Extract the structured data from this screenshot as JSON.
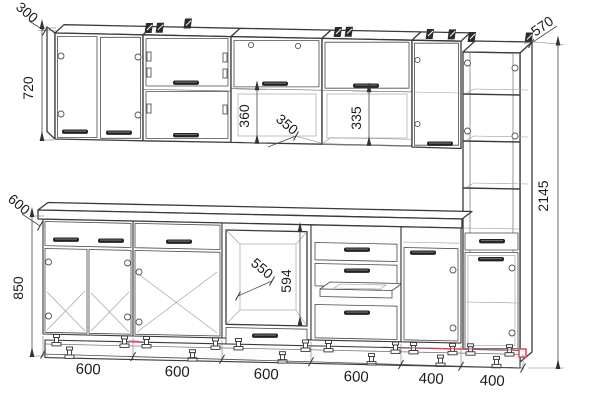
{
  "drawing": {
    "type": "kitchen-elevation-technical-drawing",
    "background": "#ffffff",
    "line_color": "#3a3a3a",
    "accent_red": "#e0506a"
  },
  "dims": {
    "wall_depth": "300",
    "wall_height": "720",
    "counter_depth": "600",
    "base_height": "850",
    "flip_height": "360",
    "shelf_depth": "350",
    "niche_height": "335",
    "oven_width": "550",
    "oven_height": "594",
    "tall_depth": "570",
    "total_height": "2145",
    "widths": [
      "600",
      "600",
      "600",
      "600",
      "400",
      "400"
    ]
  }
}
